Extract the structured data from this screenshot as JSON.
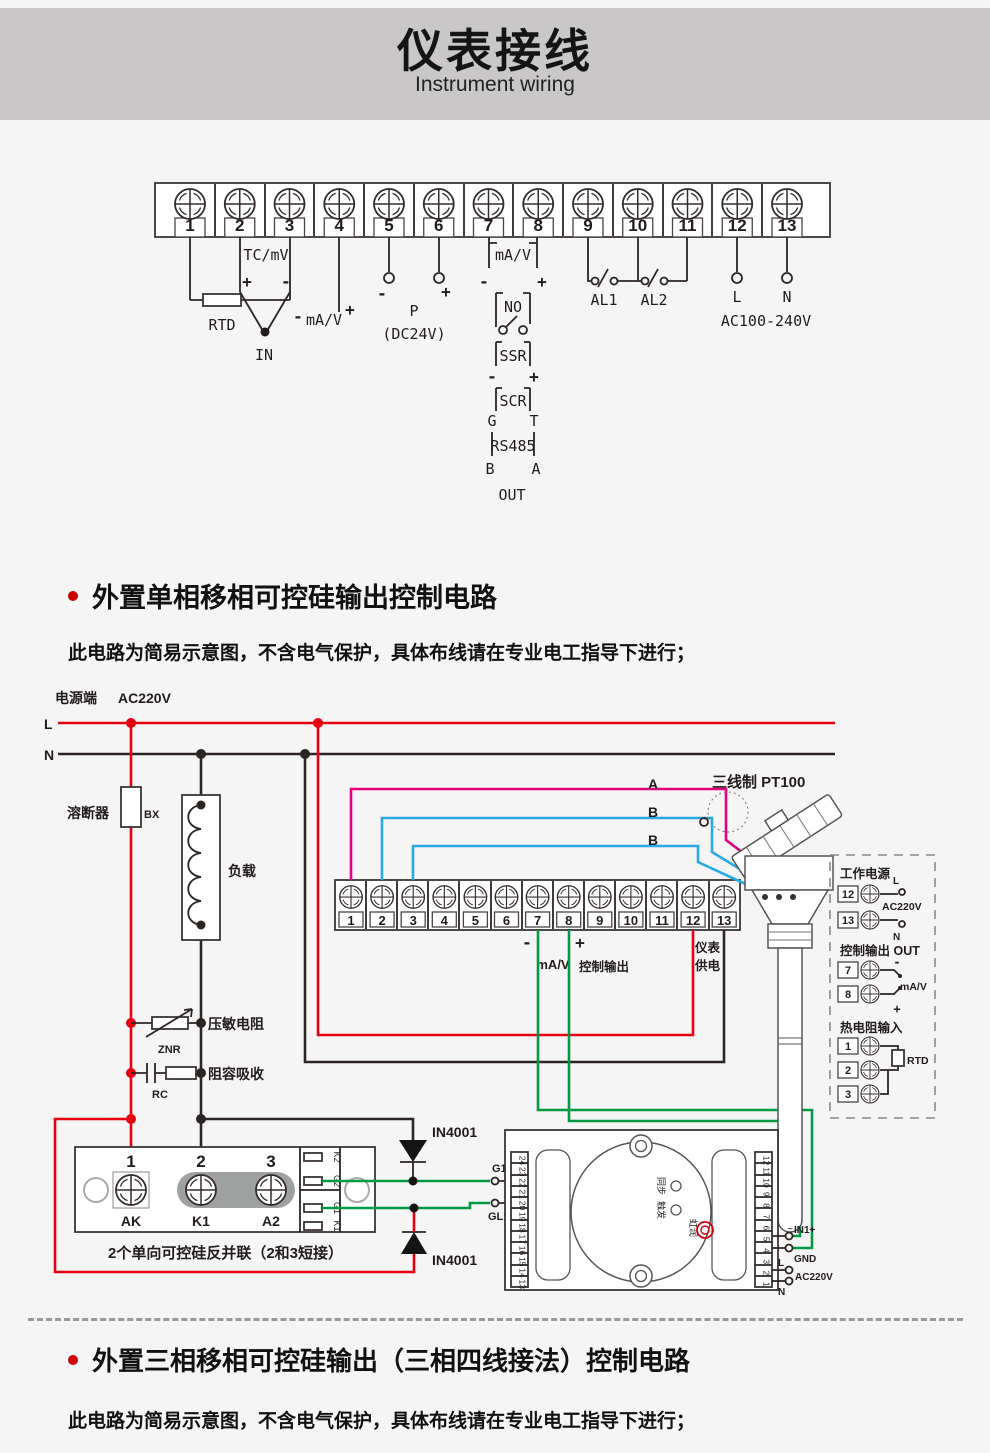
{
  "header": {
    "title": "仪表接线",
    "subtitle": "Instrument wiring"
  },
  "top_block": {
    "terminals": [
      "1",
      "2",
      "3",
      "4",
      "5",
      "6",
      "7",
      "8",
      "9",
      "10",
      "11",
      "12",
      "13"
    ],
    "tc": "TC/mV",
    "plus": "+",
    "minus": "-",
    "rtd": "RTD",
    "ma_v": "mA/V",
    "in_label": "IN",
    "p": "P",
    "dc24v": "(DC24V)",
    "no": "NO",
    "ssr": "SSR",
    "scr": "SCR",
    "g": "G",
    "t": "T",
    "rs485": "RS485",
    "b": "B",
    "a": "A",
    "out": "OUT",
    "al1": "AL1",
    "al2": "AL2",
    "l": "L",
    "n": "N",
    "ac": "AC100-240V"
  },
  "section1": {
    "title": "外置单相移相可控硅输出控制电路",
    "note": "此电路为简易示意图，不含电气保护，具体布线请在专业电工指导下进行；"
  },
  "circuit": {
    "power_label": "电源端",
    "voltage": "AC220V",
    "l": "L",
    "n": "N",
    "fuse": "溶断器",
    "fuse_code": "BX",
    "load": "负载",
    "znr_label": "压敏电阻",
    "znr": "ZNR",
    "rc_label": "阻容吸收",
    "rc": "RC",
    "terminals": [
      "1",
      "2",
      "3",
      "4",
      "5",
      "6",
      "7",
      "8",
      "9",
      "10",
      "11",
      "12",
      "13"
    ],
    "minus": "-",
    "plus": "+",
    "ma_v": "mA/V",
    "ctrl_out": "控制输出",
    "meter_supply_1": "仪表",
    "meter_supply_2": "供电",
    "pt100": "三线制 PT100",
    "wire_a": "A",
    "wire_b1": "B",
    "wire_b2": "B",
    "diode": "IN4001",
    "scr_module": {
      "n1": "1",
      "n2": "2",
      "n3": "3",
      "ak": "AK",
      "k1": "K1",
      "a2": "A2",
      "pins": [
        "K2",
        "G2",
        "G1",
        "K1"
      ],
      "caption": "2个单向可控硅反并联（2和3短接）"
    },
    "trigger": {
      "g1": "G1",
      "gl1": "GL1",
      "left_pins": [
        "24",
        "23",
        "22",
        "21",
        "20",
        "19",
        "18",
        "17",
        "16",
        "15",
        "14",
        "13"
      ],
      "right_pins": [
        "12",
        "11",
        "10",
        "9",
        "8",
        "7",
        "6",
        "5",
        "4",
        "3",
        "2",
        "1"
      ],
      "in1": "IN1+",
      "gnd": "GND",
      "l": "L",
      "n": "N",
      "ac": "AC220V",
      "ind1": "同步",
      "ind2": "触发",
      "brand": "虹润"
    },
    "sidebox": {
      "power_title": "工作电源",
      "t12": "12",
      "t13": "13",
      "l": "L",
      "n": "N",
      "ac": "AC220V",
      "out_title": "控制输出 OUT",
      "t7": "7",
      "t8": "8",
      "ma_v": "mA/V",
      "rtd_title": "热电阻输入",
      "t1": "1",
      "t2": "2",
      "t3": "3",
      "rtd": "RTD"
    }
  },
  "section2": {
    "title": "外置三相移相可控硅输出（三相四线接法）控制电路",
    "note": "此电路为简易示意图，不含电气保护，具体布线请在专业电工指导下进行；"
  }
}
